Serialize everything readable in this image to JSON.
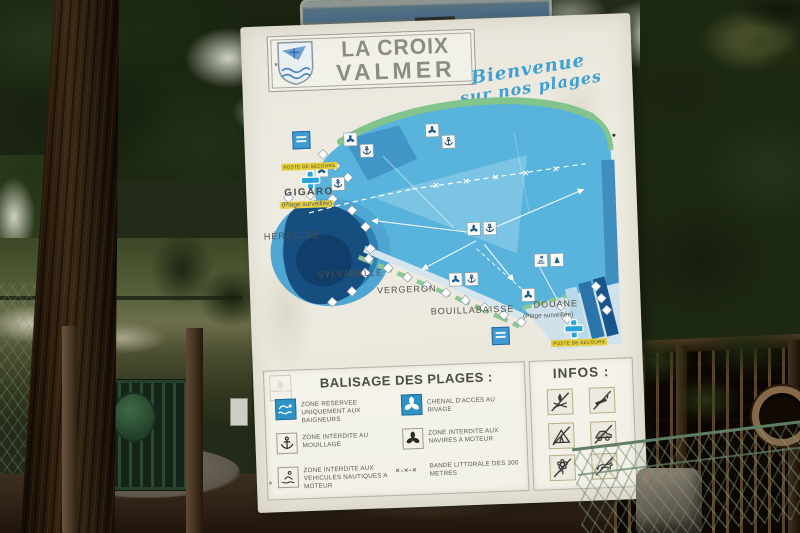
{
  "palette": {
    "script_blue": "#3d9fd4",
    "sea_blue": "#58b4dc",
    "dark_bay_blue": "#174e80",
    "legend_blue": "#2d93c4",
    "coast_green": "#82c48c",
    "highlight_yellow": "#e6d34a",
    "sign_white": "#ece9df"
  },
  "sign": {
    "title_line1": "LA CROIX",
    "title_line2": "VALMER",
    "welcome_line1": "Bienvenue",
    "welcome_line2": "sur nos plages",
    "map": {
      "first_aid_label": "POSTE DE SECOURS",
      "beaches": [
        {
          "name": "GIGARO",
          "sub": "(Plage surveillée)"
        },
        {
          "name": "HÉRACLÉE"
        },
        {
          "name": "SYLVABELLE"
        },
        {
          "name": "VERGERON"
        },
        {
          "name": "BOUILLABAISSE"
        },
        {
          "name": "DOUANE",
          "sub": "(Plage surveillée)"
        }
      ]
    },
    "legend": {
      "title": "BALISAGE DES PLAGES :",
      "items_left": [
        {
          "icon": "swimmer",
          "label": "ZONE RESERVEE UNIQUEMENT AUX BAIGNEURS"
        },
        {
          "icon": "anchor",
          "label": "ZONE INTERDITE AU MOUILLAGE"
        },
        {
          "icon": "jetski",
          "label": "ZONE INTERDITE AUX VEHICULES NAUTIQUES A MOTEUR"
        }
      ],
      "items_right": [
        {
          "icon": "propeller",
          "label": "CHENAL D'ACCES AU RIVAGE"
        },
        {
          "icon": "propeller-dark",
          "label": "ZONE INTERDITE AUX NAVIRES A MOTEUR"
        },
        {
          "icon": "shoreline-band",
          "marker": "×-×-×",
          "label": "BANDE LITTORALE DES 300 METRES"
        }
      ]
    },
    "infos": {
      "title": "INFOS :",
      "pictograms": [
        "no-campfire",
        "no-smoking",
        "no-camping",
        "no-vehicles",
        "no-flower-picking",
        "no-dogs"
      ]
    }
  }
}
